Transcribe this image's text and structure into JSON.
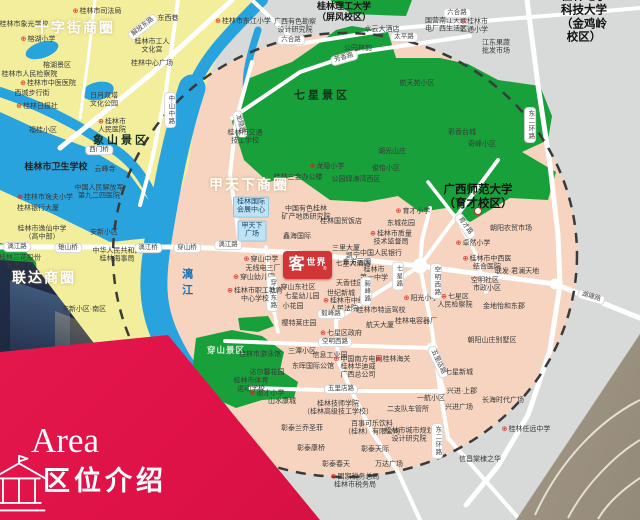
{
  "banner": {
    "en": "Area",
    "zh": "区位介绍",
    "icon": "pavilion-outline-icon",
    "bg": "#e0164a"
  },
  "logo": {
    "name": "客世界",
    "big": "客",
    "small": "世界",
    "reg": "®",
    "bg": "#d23535"
  },
  "theme": {
    "outside_circle": "#d7dad9",
    "inside_circle": "#f6d4bf",
    "old_town": "#f2ee9b",
    "park_green": "#18a13a",
    "water_blue": "#29a3dd",
    "road": "#ffffff",
    "dash_ring": "#3a3a3a",
    "poi_marker_red": "#d22015",
    "banner_red": "#e0164a"
  },
  "map": {
    "labels": [
      {
        "t": "桂林市司法局",
        "c": "poiR",
        "x": 97,
        "y": 12
      },
      {
        "t": "桂林市象光学校",
        "c": "poi",
        "x": 24,
        "y": 25
      },
      {
        "t": "十字街商圈",
        "c": "bc",
        "x": 75,
        "y": 28
      },
      {
        "t": "解放东路",
        "c": "roadD",
        "x": 143,
        "y": 27,
        "r": -38
      },
      {
        "t": "东西巷",
        "c": "poi",
        "x": 168,
        "y": 19
      },
      {
        "t": "榕湖小学",
        "c": "poiR",
        "x": 38,
        "y": 40
      },
      {
        "t": "桂林市工人\n文化宫",
        "c": "poi",
        "x": 152,
        "y": 47
      },
      {
        "t": "桂林中心广场",
        "c": "poi",
        "x": 152,
        "y": 64
      },
      {
        "t": "榕湖景区",
        "c": "poi",
        "x": 57,
        "y": 66
      },
      {
        "t": "桂林市人民检察院",
        "c": "poiR",
        "x": 26,
        "y": 75
      },
      {
        "t": "桂林市中医医院",
        "c": "poiR",
        "x": 48,
        "y": 84
      },
      {
        "t": "西城步行街",
        "c": "poi",
        "x": 32,
        "y": 94
      },
      {
        "t": "日月双塔\n文化公园",
        "c": "poi",
        "x": 104,
        "y": 101
      },
      {
        "t": "桂林日报社",
        "c": "poiR",
        "x": 37,
        "y": 107
      },
      {
        "t": "中山中路",
        "c": "roadV",
        "x": 170,
        "y": 110
      },
      {
        "t": "桂林市\n人民医院",
        "c": "poiR",
        "x": 112,
        "y": 127
      },
      {
        "t": "象山景区",
        "c": "park",
        "x": 121,
        "y": 141
      },
      {
        "t": "福桂小区",
        "c": "poi",
        "x": 43,
        "y": 131
      },
      {
        "t": "西门桥",
        "c": "roadH",
        "x": 99,
        "y": 150
      },
      {
        "t": "桂林市卫生学校",
        "c": "poi2",
        "x": 56,
        "y": 167
      },
      {
        "t": "云峰寺",
        "c": "poi",
        "x": 105,
        "y": 170
      },
      {
        "t": "桂林市逸夫小学",
        "c": "poiR",
        "x": 45,
        "y": 198
      },
      {
        "t": "桂林银行大厦",
        "c": "poi",
        "x": 38,
        "y": 209
      },
      {
        "t": "中国人民解放军\n第九二四医院",
        "c": "poi",
        "x": 99,
        "y": 193
      },
      {
        "t": "桂林市逸仙中学\n（高中部）",
        "c": "poi",
        "x": 42,
        "y": 234
      },
      {
        "t": "桂林三花股份\n有限公司",
        "c": "poi",
        "x": 20,
        "y": 263
      },
      {
        "t": "安新小区",
        "c": "poi",
        "x": 104,
        "y": 233
      },
      {
        "t": "漓江路",
        "c": "roadH",
        "x": 17,
        "y": 247
      },
      {
        "t": "雉山桥",
        "c": "roadH",
        "x": 68,
        "y": 248
      },
      {
        "t": "中华人民共和国\n桂林海事局",
        "c": "poi",
        "x": 117,
        "y": 256
      },
      {
        "t": "漓江桥",
        "c": "roadH",
        "x": 148,
        "y": 248
      },
      {
        "t": "穿山桥",
        "c": "roadH",
        "x": 187,
        "y": 248
      },
      {
        "t": "漓江",
        "c": "riv",
        "x": 186,
        "y": 284
      },
      {
        "t": "安新小区·南区",
        "c": "poi",
        "x": 84,
        "y": 310
      },
      {
        "t": "联达商圈",
        "c": "bc",
        "x": 44,
        "y": 278
      },
      {
        "t": "桂林理工大学\n（屏风校区）",
        "c": "uni2",
        "x": 344,
        "y": 12
      },
      {
        "t": "桂林市东江小学",
        "c": "poiR",
        "x": 243,
        "y": 22
      },
      {
        "t": "广西有色勘察\n设计研究院",
        "c": "poi",
        "x": 295,
        "y": 27
      },
      {
        "t": "六合路",
        "c": "roadH",
        "x": 291,
        "y": 40
      },
      {
        "t": "公园林韵",
        "c": "poi",
        "x": 358,
        "y": 49
      },
      {
        "t": "芳香路",
        "c": "roadD",
        "x": 344,
        "y": 58,
        "r": -16
      },
      {
        "t": "水云大酒店",
        "c": "poi",
        "x": 382,
        "y": 30
      },
      {
        "t": "太平路",
        "c": "roadH",
        "x": 404,
        "y": 37
      },
      {
        "t": "航天苑小区",
        "c": "poi",
        "x": 417,
        "y": 84
      },
      {
        "t": "国营南江天线\n电厂西生活区",
        "c": "poi",
        "x": 446,
        "y": 26
      },
      {
        "t": "桂林市\n汇通小学",
        "c": "poiR",
        "x": 474,
        "y": 27
      },
      {
        "t": "六合路",
        "c": "roadH",
        "x": 457,
        "y": 13
      },
      {
        "t": "江东果蔬\n批发市场",
        "c": "poi",
        "x": 496,
        "y": 48
      },
      {
        "t": "桂林电子科技大学\n（金鸡岭校区）",
        "c": "uni",
        "x": 584,
        "y": 18
      },
      {
        "t": "东二环路",
        "c": "roadV",
        "x": 530,
        "y": 125
      },
      {
        "t": "彩香台城",
        "c": "poi",
        "x": 462,
        "y": 133
      },
      {
        "t": "奇峰小区",
        "c": "poi",
        "x": 482,
        "y": 145
      },
      {
        "t": "七星景区",
        "c": "park",
        "x": 322,
        "y": 96
      },
      {
        "t": "龙隐路",
        "c": "roadD",
        "x": 240,
        "y": 124,
        "r": 75
      },
      {
        "t": "桂林市交通\n技工学校",
        "c": "poi",
        "x": 245,
        "y": 138
      },
      {
        "t": "龙隐小学",
        "c": "poiR",
        "x": 327,
        "y": 167
      },
      {
        "t": "桂林三金办公楼",
        "c": "poi",
        "x": 298,
        "y": 178
      },
      {
        "t": "公园绿涛湾西区",
        "c": "poi",
        "x": 356,
        "y": 180
      },
      {
        "t": "俊怡小区",
        "c": "poi",
        "x": 386,
        "y": 169
      },
      {
        "t": "湖光山庄",
        "c": "poi",
        "x": 392,
        "y": 152
      },
      {
        "t": "东城花园",
        "c": "poi",
        "x": 401,
        "y": 224
      },
      {
        "t": "育才小学",
        "c": "poiR",
        "x": 413,
        "y": 212
      },
      {
        "t": "甲天下商圈",
        "c": "bc",
        "x": 249,
        "y": 185
      },
      {
        "t": "桂林国际\n会展中心",
        "c": "blueBox",
        "x": 251,
        "y": 207
      },
      {
        "t": "甲天下\n广场",
        "c": "blueBox",
        "x": 252,
        "y": 231
      },
      {
        "t": "中国有色桂林\n矿产地质研究院",
        "c": "poi",
        "x": 306,
        "y": 214
      },
      {
        "t": "桂林国贸饭店",
        "c": "poi",
        "x": 341,
        "y": 222
      },
      {
        "t": "鑫海国际",
        "c": "poi",
        "x": 297,
        "y": 237
      },
      {
        "t": "漓江路",
        "c": "roadH",
        "x": 228,
        "y": 245
      },
      {
        "t": "凯宁\n七星大酒店",
        "c": "poi",
        "x": 353,
        "y": 261
      },
      {
        "t": "穿山中学",
        "c": "poiR",
        "x": 261,
        "y": 260
      },
      {
        "t": "无线电三厂",
        "c": "poi",
        "x": 263,
        "y": 269
      },
      {
        "t": "穿山幼儿园",
        "c": "poiR",
        "x": 254,
        "y": 278
      },
      {
        "t": "穿山东路",
        "c": "roadV",
        "x": 272,
        "y": 294
      },
      {
        "t": "穿山东社区",
        "c": "poi",
        "x": 298,
        "y": 288
      },
      {
        "t": "七星幼儿园",
        "c": "poi",
        "x": 302,
        "y": 297
      },
      {
        "t": "小花园",
        "c": "poi",
        "x": 293,
        "y": 307
      },
      {
        "t": "桂林市职工教育\n中心学校",
        "c": "poiR",
        "x": 255,
        "y": 296
      },
      {
        "t": "天香佳园",
        "c": "poi",
        "x": 350,
        "y": 284
      },
      {
        "t": "世纪新城",
        "c": "poi",
        "x": 341,
        "y": 294
      },
      {
        "t": "桂林市中级\n人民法院",
        "c": "poiR",
        "x": 344,
        "y": 306
      },
      {
        "t": "樱特莱庄园",
        "c": "poi",
        "x": 299,
        "y": 324
      },
      {
        "t": "毅峰路",
        "c": "roadH",
        "x": 331,
        "y": 314
      },
      {
        "t": "航天大厦",
        "c": "poi",
        "x": 380,
        "y": 326
      },
      {
        "t": "桂林电容器厂",
        "c": "poi",
        "x": 416,
        "y": 322
      },
      {
        "t": "桂林市特运驾校",
        "c": "poi",
        "x": 381,
        "y": 311
      },
      {
        "t": "三里大厦",
        "c": "poi",
        "x": 346,
        "y": 249
      },
      {
        "t": "中国人民银行",
        "c": "poi",
        "x": 381,
        "y": 254
      },
      {
        "t": "东方丽园",
        "c": "poi",
        "x": 357,
        "y": 263
      },
      {
        "t": "桂林市\n第一中学",
        "c": "poi",
        "x": 374,
        "y": 275
      },
      {
        "t": "桂林市质量\n技术监督局",
        "c": "poiR",
        "x": 391,
        "y": 239
      },
      {
        "t": "七星路",
        "c": "roadV",
        "x": 398,
        "y": 276
      },
      {
        "t": "毅峰路",
        "c": "roadV",
        "x": 366,
        "y": 291
      },
      {
        "t": "阳光小学",
        "c": "poiR",
        "x": 421,
        "y": 299
      },
      {
        "t": "空明西路",
        "c": "roadV",
        "x": 436,
        "y": 281
      },
      {
        "t": "广西师范大学\n（育才校区）",
        "c": "uni",
        "x": 478,
        "y": 198
      },
      {
        "t": "",
        "c": "mark",
        "x": 478,
        "y": 211
      },
      {
        "t": "育才路",
        "c": "roadD",
        "x": 465,
        "y": 226,
        "r": 55
      },
      {
        "t": "朝阳农贸市场",
        "c": "poi",
        "x": 511,
        "y": 229
      },
      {
        "t": "卓然小学",
        "c": "poiR",
        "x": 473,
        "y": 244
      },
      {
        "t": "桂林市中西医\n结合医院",
        "c": "poiR",
        "x": 487,
        "y": 264
      },
      {
        "t": "联发·君澜天地",
        "c": "poi",
        "x": 517,
        "y": 272
      },
      {
        "t": "空明社区",
        "c": "poi",
        "x": 485,
        "y": 281
      },
      {
        "t": "市政小区",
        "c": "poi",
        "x": 487,
        "y": 289
      },
      {
        "t": "七星区\n人民检察院",
        "c": "poiR",
        "x": 455,
        "y": 302
      },
      {
        "t": "金地怡和东郡",
        "c": "poi",
        "x": 504,
        "y": 307
      },
      {
        "t": "湖塘路",
        "c": "roadD",
        "x": 591,
        "y": 297,
        "r": 16
      },
      {
        "t": "穿山景区",
        "c": "parkL",
        "x": 226,
        "y": 350
      },
      {
        "t": "空明西路",
        "c": "roadH",
        "x": 335,
        "y": 342
      },
      {
        "t": "七星区政府",
        "c": "poiR",
        "x": 341,
        "y": 334
      },
      {
        "t": "三潭小区",
        "c": "poi",
        "x": 302,
        "y": 352
      },
      {
        "t": "信息工业园",
        "c": "poi",
        "x": 330,
        "y": 356
      },
      {
        "t": "中国南方电网",
        "c": "poiR",
        "x": 358,
        "y": 360
      },
      {
        "t": "桂林海关",
        "c": "poiR",
        "x": 393,
        "y": 360
      },
      {
        "t": "东晖国际公馆",
        "c": "poi",
        "x": 313,
        "y": 367
      },
      {
        "t": "桂林华迪威\n广西总公司",
        "c": "poi",
        "x": 358,
        "y": 372
      },
      {
        "t": "桂林市游泳馆",
        "c": "poi",
        "x": 260,
        "y": 355
      },
      {
        "t": "达尔馨花园",
        "c": "poi",
        "x": 267,
        "y": 373
      },
      {
        "t": "桂林市体育\n运动学校",
        "c": "poi",
        "x": 251,
        "y": 386
      },
      {
        "t": "德才小学",
        "c": "poiR",
        "x": 267,
        "y": 394
      },
      {
        "t": "山水康城",
        "c": "poi",
        "x": 282,
        "y": 402
      },
      {
        "t": "五里店路",
        "c": "roadH",
        "x": 341,
        "y": 389
      },
      {
        "t": "桂林技师学院\n（桂林高级技工学校）",
        "c": "poi",
        "x": 338,
        "y": 409
      },
      {
        "t": "百事可乐饮料\n（桂林）有限公司",
        "c": "poi",
        "x": 372,
        "y": 429
      },
      {
        "t": "彰泰兰乔圣菲",
        "c": "poi",
        "x": 302,
        "y": 429
      },
      {
        "t": "彰泰康桥",
        "c": "poi",
        "x": 311,
        "y": 449
      },
      {
        "t": "彰泰天际",
        "c": "poi",
        "x": 375,
        "y": 450
      },
      {
        "t": "彰泰春天",
        "c": "poi",
        "x": 336,
        "y": 465
      },
      {
        "t": "万达广场",
        "c": "poi",
        "x": 389,
        "y": 465
      },
      {
        "t": "国家税务总局\n桂林市税务局",
        "c": "poiR",
        "x": 355,
        "y": 482
      },
      {
        "t": "二支队车管所",
        "c": "poi",
        "x": 408,
        "y": 410
      },
      {
        "t": "桂林市城市规划\n设计研究院",
        "c": "poi",
        "x": 409,
        "y": 436
      },
      {
        "t": "朝阳山庄别墅区",
        "c": "poi",
        "x": 492,
        "y": 341
      },
      {
        "t": "五里店路",
        "c": "roadD",
        "x": 438,
        "y": 362,
        "r": 65
      },
      {
        "t": "七星新城",
        "c": "poi",
        "x": 459,
        "y": 373
      },
      {
        "t": "兴进·上郡",
        "c": "poi",
        "x": 462,
        "y": 392
      },
      {
        "t": "一航小区",
        "c": "poi",
        "x": 431,
        "y": 399
      },
      {
        "t": "兴进广场",
        "c": "poi",
        "x": 459,
        "y": 408
      },
      {
        "t": "长海时代广场",
        "c": "poi",
        "x": 503,
        "y": 401
      },
      {
        "t": "东二环路",
        "c": "roadV",
        "x": 437,
        "y": 441
      },
      {
        "t": "桂林任远中学",
        "c": "poiR",
        "x": 526,
        "y": 430
      },
      {
        "t": "信昌棠棣之华",
        "c": "poi",
        "x": 480,
        "y": 460
      }
    ]
  }
}
